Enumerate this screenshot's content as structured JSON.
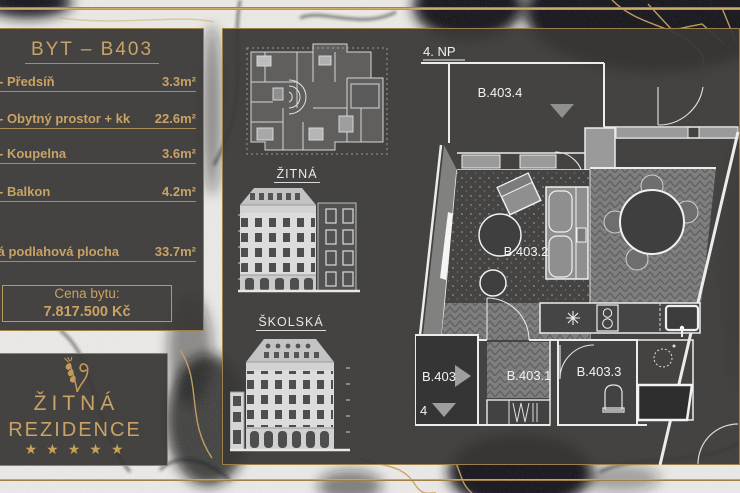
{
  "info_panel": {
    "title": "BYT – B403",
    "rows": [
      {
        "label": "- Předsíň",
        "value": "3.3m²"
      },
      {
        "label": "- Obytný prostor + kk",
        "value": "22.6m²"
      },
      {
        "label": "- Koupelna",
        "value": "3.6m²"
      },
      {
        "label": "- Balkon",
        "value": "4.2m²"
      }
    ],
    "total_row": {
      "label": "Celková podlahová plocha",
      "value": "33.7m²"
    },
    "price_box": {
      "label": "Cena bytu:",
      "value": "7.817.500 Kč"
    }
  },
  "logo_panel": {
    "name_line1": "ŽITNÁ",
    "name_line2": "REZIDENCE",
    "rating_stars": "★★★★★"
  },
  "middle_panel": {
    "street1_label": "ŽITNÁ",
    "street2_label": "ŠKOLSKÁ"
  },
  "floor_plan": {
    "floor_label": "4. NP",
    "unit_number": "4",
    "room_ids": {
      "terrace": "B.403.4",
      "living": "B.403.2",
      "entry": "B.403",
      "hall": "B.403.1",
      "bath": "B.403.3"
    }
  },
  "colors": {
    "gold": "#c9a265",
    "panel_dark": "#393836",
    "plan_line": "#ededed",
    "plan_gray": "#9a9a9a"
  }
}
